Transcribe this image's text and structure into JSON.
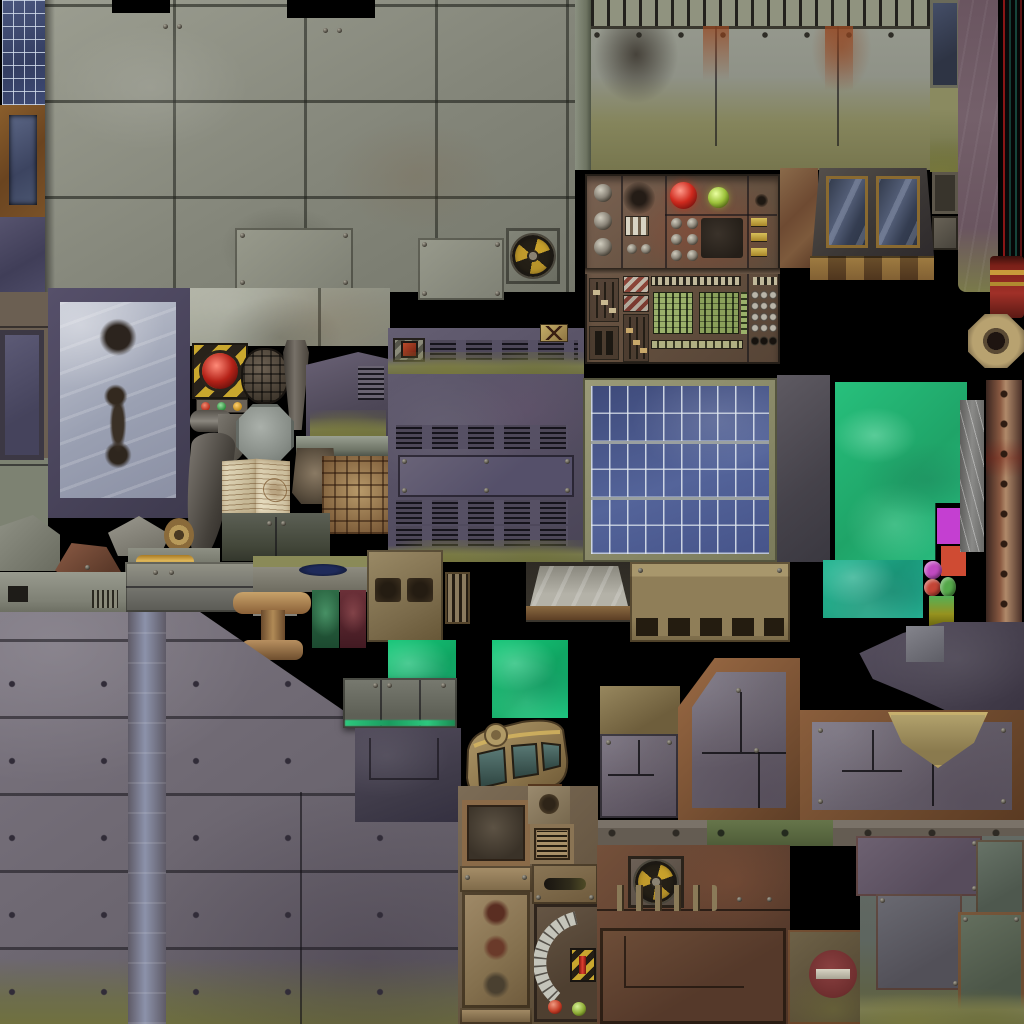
{
  "atlas": {
    "title": "Industrial sci-fi game texture atlas",
    "background": "#000000",
    "swatches": {
      "magenta": "#c43fd1",
      "red": "#cf4b33",
      "olive": "#96921f",
      "toxic_green": "#2dc87e",
      "solar_blue": "#4a5a8c",
      "hazard_yellow": "#c9a72e",
      "dome_red": "#cf2a1e",
      "dome_green": "#9dc23b",
      "button_magenta": "#c04ac0",
      "button_red": "#c44536",
      "button_green": "#55a84a"
    },
    "tiles": [
      {
        "name": "solar-strip-topleft",
        "x": 2,
        "y": 0,
        "w": 43,
        "h": 105,
        "color": "#3e4a74",
        "desc": "blue solar cell strip"
      },
      {
        "name": "framed-pane-topleft",
        "x": 0,
        "y": 105,
        "w": 46,
        "h": 112,
        "color": "#7a5228",
        "desc": "rust framed blue pane"
      },
      {
        "name": "purple-pane-topleft",
        "x": 0,
        "y": 217,
        "w": 46,
        "h": 75,
        "color": "#4c4a66",
        "desc": "dark purple pane"
      },
      {
        "name": "stone-block-wall",
        "x": 45,
        "y": 0,
        "w": 530,
        "h": 292,
        "color": "#8f9184",
        "desc": "large grey stone block wall"
      },
      {
        "name": "wall-plate-a",
        "x": 235,
        "y": 228,
        "w": 118,
        "h": 62,
        "color": "#8e9082"
      },
      {
        "name": "wall-plate-b",
        "x": 418,
        "y": 238,
        "w": 86,
        "h": 62,
        "color": "#8e9082"
      },
      {
        "name": "radiation-fan-plate-top",
        "x": 506,
        "y": 228,
        "w": 54,
        "h": 56,
        "color": "#c8a12c",
        "desc": "radiation trefoil fan emblem"
      },
      {
        "name": "left-plate-column",
        "x": 0,
        "y": 292,
        "w": 48,
        "h": 268,
        "color": "#6b5f52"
      },
      {
        "name": "stained-door",
        "x": 48,
        "y": 288,
        "w": 142,
        "h": 230,
        "color": "#b4b8c4",
        "desc": "icy panel with oil stains"
      },
      {
        "name": "light-stone-band",
        "x": 190,
        "y": 288,
        "w": 200,
        "h": 58,
        "color": "#9a9c90"
      },
      {
        "name": "hazard-lamp-box",
        "x": 192,
        "y": 343,
        "w": 56,
        "h": 56,
        "color": "#c9a72e",
        "desc": "yellow-black hazard box with red dome lamp"
      },
      {
        "name": "indicator-bar",
        "x": 196,
        "y": 399,
        "w": 52,
        "h": 14,
        "color": "#6a6258",
        "desc": "red green amber indicator lights"
      },
      {
        "name": "grenade-prop",
        "x": 243,
        "y": 350,
        "w": 44,
        "h": 52,
        "color": "#4e4438"
      },
      {
        "name": "metal-post",
        "x": 283,
        "y": 340,
        "w": 26,
        "h": 90,
        "color": "#6a665e"
      },
      {
        "name": "vent-shed",
        "x": 306,
        "y": 352,
        "w": 84,
        "h": 92,
        "color": "#5c5468",
        "desc": "purple shed with vents and grass"
      },
      {
        "name": "pipe-horizontal",
        "x": 190,
        "y": 410,
        "w": 42,
        "h": 22,
        "color": "#7a766e"
      },
      {
        "name": "pipe-elbow",
        "x": 218,
        "y": 414,
        "w": 30,
        "h": 48,
        "color": "#6e6a62"
      },
      {
        "name": "tusk-prop",
        "x": 186,
        "y": 432,
        "w": 48,
        "h": 130,
        "color": "#55504a",
        "desc": "curved horn"
      },
      {
        "name": "octagon-plate",
        "x": 236,
        "y": 404,
        "w": 58,
        "h": 60,
        "color": "#9aa09a"
      },
      {
        "name": "open-book",
        "x": 222,
        "y": 458,
        "w": 68,
        "h": 57,
        "color": "#d8cdb0",
        "desc": "open book with diagram"
      },
      {
        "name": "bronze-cap",
        "x": 292,
        "y": 448,
        "w": 46,
        "h": 56,
        "color": "#7a6a58"
      },
      {
        "name": "ledge-molding",
        "x": 296,
        "y": 436,
        "w": 94,
        "h": 20,
        "color": "#8a8e80"
      },
      {
        "name": "maze-relief",
        "x": 322,
        "y": 456,
        "w": 68,
        "h": 78,
        "color": "#8a6a44",
        "desc": "rusty maze relief"
      },
      {
        "name": "cabinet",
        "x": 222,
        "y": 513,
        "w": 108,
        "h": 48,
        "color": "#4e5248",
        "desc": "two-door cabinet"
      },
      {
        "name": "purple-vent-wall",
        "x": 388,
        "y": 328,
        "w": 196,
        "h": 234,
        "color": "#5c5668",
        "desc": "purple wall with vent rows and grass"
      },
      {
        "name": "skull-warning-icon",
        "x": 540,
        "y": 324,
        "w": 28,
        "h": 18,
        "color": "#b89a5a"
      },
      {
        "name": "ramp-chute",
        "x": 526,
        "y": 562,
        "w": 106,
        "h": 60,
        "color": "#b0b0a8"
      },
      {
        "name": "control-panel",
        "x": 585,
        "y": 174,
        "w": 195,
        "h": 190,
        "color": "#6d5848",
        "desc": "rusty control panel with knobs, domes, LED grids"
      },
      {
        "name": "rust-pillar",
        "x": 780,
        "y": 168,
        "w": 38,
        "h": 100,
        "color": "#7a4a2c"
      },
      {
        "name": "window",
        "x": 812,
        "y": 168,
        "w": 122,
        "h": 88,
        "color": "#3a4458",
        "desc": "double pane window"
      },
      {
        "name": "window-sill",
        "x": 810,
        "y": 256,
        "w": 124,
        "h": 24,
        "color": "#6b4a30"
      },
      {
        "name": "mossy-top-wall",
        "x": 575,
        "y": 0,
        "w": 360,
        "h": 170,
        "color": "#8f9287",
        "desc": "wall with slat row, rust streaks, moss"
      },
      {
        "name": "small-pane-top",
        "x": 930,
        "y": 0,
        "w": 30,
        "h": 88,
        "color": "#3a3e4a"
      },
      {
        "name": "moss-column",
        "x": 930,
        "y": 88,
        "w": 30,
        "h": 84,
        "color": "#7a7a50"
      },
      {
        "name": "plaque-a",
        "x": 932,
        "y": 172,
        "w": 26,
        "h": 42,
        "color": "#4a443c"
      },
      {
        "name": "plaque-b",
        "x": 932,
        "y": 216,
        "w": 26,
        "h": 34,
        "color": "#5a5248"
      },
      {
        "name": "mauve-pillar",
        "x": 958,
        "y": 0,
        "w": 40,
        "h": 292,
        "color": "#6a5560"
      },
      {
        "name": "color-strip-column",
        "x": 1000,
        "y": 0,
        "w": 24,
        "h": 262,
        "color": "#8a1616",
        "desc": "thin red and teal vertical strips"
      },
      {
        "name": "red-pot",
        "x": 990,
        "y": 256,
        "w": 34,
        "h": 62,
        "color": "#a03028"
      },
      {
        "name": "octagon-nut",
        "x": 968,
        "y": 314,
        "w": 56,
        "h": 54,
        "color": "#a89468"
      },
      {
        "name": "solar-panel",
        "x": 583,
        "y": 378,
        "w": 194,
        "h": 184,
        "color": "#4a5a8c",
        "desc": "blue solar panel, 10x6 cells"
      },
      {
        "name": "dark-slab",
        "x": 777,
        "y": 375,
        "w": 53,
        "h": 187,
        "color": "#55525a"
      },
      {
        "name": "toxic-green-large",
        "x": 835,
        "y": 382,
        "w": 132,
        "h": 178,
        "color": "#2dc87e"
      },
      {
        "name": "toxic-green-small",
        "x": 823,
        "y": 560,
        "w": 100,
        "h": 58,
        "color": "#2ab58a"
      },
      {
        "name": "magenta-square",
        "x": 937,
        "y": 508,
        "w": 29,
        "h": 36,
        "color": "#c43fd1"
      },
      {
        "name": "red-square",
        "x": 941,
        "y": 546,
        "w": 25,
        "h": 30,
        "color": "#cf4b33"
      },
      {
        "name": "magenta-button",
        "x": 924,
        "y": 561,
        "w": 18,
        "h": 18,
        "color": "#c04ac0"
      },
      {
        "name": "red-button",
        "x": 924,
        "y": 579,
        "w": 17,
        "h": 17,
        "color": "#c44536"
      },
      {
        "name": "green-button",
        "x": 940,
        "y": 577,
        "w": 16,
        "h": 20,
        "color": "#55a84a"
      },
      {
        "name": "olive-square",
        "x": 929,
        "y": 596,
        "w": 25,
        "h": 30,
        "color": "#96921f"
      },
      {
        "name": "scratched-pillar",
        "x": 960,
        "y": 400,
        "w": 24,
        "h": 152,
        "color": "#7a7a78"
      },
      {
        "name": "rust-pole",
        "x": 986,
        "y": 380,
        "w": 36,
        "h": 244,
        "color": "#8a5a42"
      },
      {
        "name": "keypad-block",
        "x": 0,
        "y": 572,
        "w": 126,
        "h": 42,
        "color": "#8e9186"
      },
      {
        "name": "pentagon-shard",
        "x": 55,
        "y": 543,
        "w": 66,
        "h": 50,
        "color": "#6a4a3c"
      },
      {
        "name": "beam-gold",
        "x": 128,
        "y": 548,
        "w": 92,
        "h": 32,
        "color": "#c9972f"
      },
      {
        "name": "crossbar",
        "x": 125,
        "y": 562,
        "w": 132,
        "h": 50,
        "color": "#8a8a84"
      },
      {
        "name": "grass-plate",
        "x": 253,
        "y": 556,
        "w": 115,
        "h": 36,
        "color": "#8a8878",
        "desc": "plate with olive top and puddle"
      },
      {
        "name": "striped-bar",
        "x": 253,
        "y": 592,
        "w": 44,
        "h": 24,
        "color": "#77736b"
      },
      {
        "name": "t-press",
        "x": 233,
        "y": 588,
        "w": 78,
        "h": 74,
        "color": "#a8865a",
        "desc": "bronze T shaped press"
      },
      {
        "name": "green-cloth-strip",
        "x": 312,
        "y": 590,
        "w": 27,
        "h": 58,
        "color": "#2e6b46"
      },
      {
        "name": "red-cloth-strip",
        "x": 340,
        "y": 590,
        "w": 26,
        "h": 58,
        "color": "#6b3038"
      },
      {
        "name": "vent-box",
        "x": 367,
        "y": 550,
        "w": 76,
        "h": 92,
        "color": "#8a7a5e"
      },
      {
        "name": "slat-box",
        "x": 445,
        "y": 572,
        "w": 25,
        "h": 52,
        "color": "#8a7a5e"
      },
      {
        "name": "wedge-piece",
        "x": 108,
        "y": 516,
        "w": 62,
        "h": 40,
        "color": "#8a8880"
      },
      {
        "name": "washer-flower",
        "x": 164,
        "y": 518,
        "w": 30,
        "h": 34,
        "color": "#b89a5a"
      },
      {
        "name": "small-trapezoids",
        "x": 0,
        "y": 515,
        "w": 60,
        "h": 56,
        "color": "#84867a"
      },
      {
        "name": "emerald-square-a",
        "x": 388,
        "y": 640,
        "w": 68,
        "h": 77,
        "color": "#20c878"
      },
      {
        "name": "emerald-square-b",
        "x": 492,
        "y": 640,
        "w": 76,
        "h": 78,
        "color": "#20c878"
      },
      {
        "name": "hinge-panel",
        "x": 343,
        "y": 678,
        "w": 114,
        "h": 50,
        "color": "#6e7068",
        "desc": "riveted panel with toxic glow seam"
      },
      {
        "name": "dark-panel-bottom-mid",
        "x": 355,
        "y": 728,
        "w": 106,
        "h": 94,
        "color": "#46424e"
      },
      {
        "name": "cockpit-prop",
        "x": 462,
        "y": 716,
        "w": 108,
        "h": 86,
        "color": "#9a8258",
        "desc": "curved dashboard with teal windows"
      },
      {
        "name": "small-rust-square",
        "x": 528,
        "y": 784,
        "w": 34,
        "h": 26,
        "color": "#7a5a3a"
      },
      {
        "name": "door-column",
        "x": 458,
        "y": 786,
        "w": 140,
        "h": 238,
        "color": "#7a6a55",
        "desc": "door with stains, vent, slot, gauge panel"
      },
      {
        "name": "tan-vent-panel",
        "x": 630,
        "y": 562,
        "w": 160,
        "h": 80,
        "color": "#9a8a62"
      },
      {
        "name": "tan-block",
        "x": 600,
        "y": 686,
        "w": 80,
        "h": 48,
        "color": "#8a7a58"
      },
      {
        "name": "diagonal-corner-panel",
        "x": 678,
        "y": 658,
        "w": 122,
        "h": 164,
        "color": "#7a5a3c",
        "desc": "rust framed panel, cut corner"
      },
      {
        "name": "seam-panel",
        "x": 600,
        "y": 734,
        "w": 78,
        "h": 84,
        "color": "#5e5a66"
      },
      {
        "name": "pipe-elbow-dark",
        "x": 856,
        "y": 622,
        "w": 168,
        "h": 92,
        "color": "#4e4450"
      },
      {
        "name": "grey-square-small",
        "x": 906,
        "y": 626,
        "w": 38,
        "h": 36,
        "color": "#7a7a80"
      },
      {
        "name": "funnel-panel",
        "x": 800,
        "y": 710,
        "w": 224,
        "h": 112,
        "color": "#6e4a32",
        "desc": "rust framed panel with khaki funnel"
      },
      {
        "name": "rivet-strip",
        "x": 598,
        "y": 820,
        "w": 426,
        "h": 26,
        "color": "#6a6258"
      },
      {
        "name": "rust-wall-bottom",
        "x": 597,
        "y": 845,
        "w": 193,
        "h": 179,
        "color": "#6b4a36",
        "desc": "rusty wall, radiation plate, pins, framed plate"
      },
      {
        "name": "radiation-fan-plate-bottom",
        "x": 628,
        "y": 856,
        "w": 56,
        "h": 52,
        "color": "#c8a12c"
      },
      {
        "name": "no-entry-plate",
        "x": 788,
        "y": 930,
        "w": 92,
        "h": 94,
        "color": "#7a3434",
        "desc": "faded no-entry sign on mossy plate"
      },
      {
        "name": "patchwork-plates",
        "x": 860,
        "y": 836,
        "w": 164,
        "h": 188,
        "color": "#5e6660",
        "desc": "overlapping riveted plates, mossy"
      },
      {
        "name": "riveted-wall-bottomleft",
        "x": 0,
        "y": 612,
        "w": 462,
        "h": 412,
        "color": "#6e6870",
        "desc": "large riveted metal wall, diagonal edge, grass"
      }
    ]
  }
}
